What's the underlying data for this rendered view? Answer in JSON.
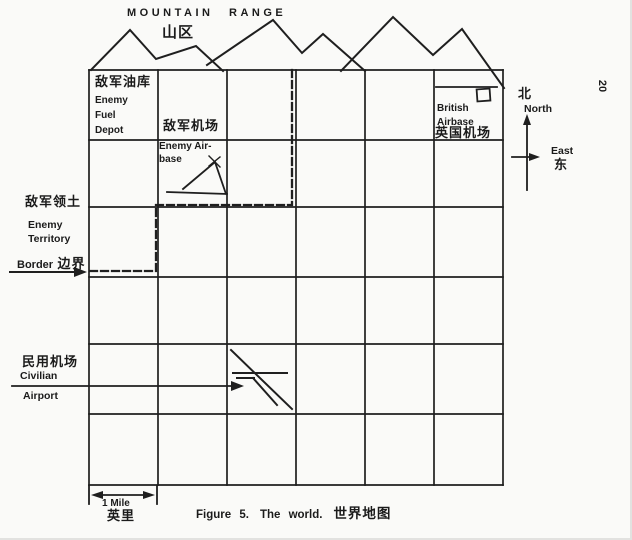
{
  "figure": {
    "page_number": "20",
    "caption": {
      "figure_label": "Figure 5.",
      "title_en": "The world.",
      "title_zh": "世界地图"
    }
  },
  "mountain_range": {
    "label_en": "MOUNTAIN RANGE",
    "label_zh": "山区"
  },
  "compass": {
    "north_zh": "北",
    "north_en": "North",
    "east_en": "East",
    "east_zh": "东"
  },
  "map": {
    "grid": {
      "columns": 6,
      "rows": 6
    },
    "enemy_fuel_depot": {
      "label_zh": "敌军油库",
      "line1": "Enemy",
      "line2": "Fuel",
      "line3": "Depot"
    },
    "enemy_airbase": {
      "label_zh": "敌军机场",
      "line1": "Enemy Air-",
      "line2": "base"
    },
    "british_airbase": {
      "line1": "British",
      "line2": "Airbase",
      "label_zh": "英国机场"
    },
    "civilian_airport": {
      "label_zh": "民用机场",
      "line1": "Civilian",
      "line2": "Airport"
    },
    "enemy_territory": {
      "label_zh": "敌军领土",
      "line1": "Enemy",
      "line2": "Territory"
    },
    "border": {
      "label_en": "Border",
      "label_zh": "边界"
    }
  },
  "scale_bar": {
    "label_en": "1 Mile",
    "label_zh": "英里"
  },
  "colors": {
    "ink": "#1b1b1b",
    "paper": "#fafaf8"
  }
}
